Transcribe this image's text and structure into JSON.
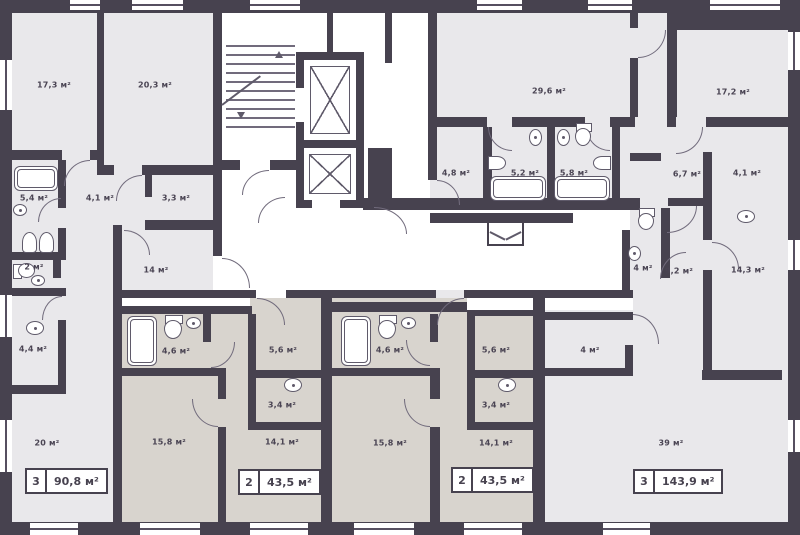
{
  "meta": {
    "type": "residential floor plan",
    "units": "м²"
  },
  "colors": {
    "wall": "#47424f",
    "apartment_light_fill": "#e9e8eb",
    "apartment_beige_fill": "#d8d4ce",
    "corridor_fill": "#ffffff",
    "fixture_line": "#5f5a6a",
    "label_text": "#4a4453"
  },
  "rooms": {
    "a1_173": "17,3 м²",
    "a1_203": "20,3 м²",
    "a1_54": "5,4 м²",
    "a1_41": "4,1 м²",
    "a1_33": "3,3 м²",
    "a1_2": "2 м²",
    "a1_14": "14 м²",
    "a1_44": "4,4 м²",
    "a1_20": "20 м²",
    "a2_46": "4,6 м²",
    "a2_56": "5,6 м²",
    "a2_34": "3,4 м²",
    "a2_158": "15,8 м²",
    "a2_141": "14,1 м²",
    "a3_46": "4,6 м²",
    "a3_56": "5,6 м²",
    "a3_34": "3,4 м²",
    "a3_158": "15,8 м²",
    "a3_141": "14,1 м²",
    "a4_296": "29,6 м²",
    "a4_172": "17,2 м²",
    "a4_48": "4,8 м²",
    "a4_52": "5,2 м²",
    "a4_58": "5,8 м²",
    "a4_67": "6,7 м²",
    "a4_41": "4,1 м²",
    "a4_4wc": "4 м²",
    "a4_92": "9,2 м²",
    "a4_143": "14,3 м²",
    "a4_4": "4 м²",
    "a4_39": "39 м²"
  },
  "badges": {
    "apt1": {
      "rooms": "3",
      "area": "90,8 м²"
    },
    "apt2": {
      "rooms": "2",
      "area": "43,5 м²"
    },
    "apt3": {
      "rooms": "2",
      "area": "43,5 м²"
    },
    "apt4": {
      "rooms": "3",
      "area": "143,9 м²"
    }
  }
}
